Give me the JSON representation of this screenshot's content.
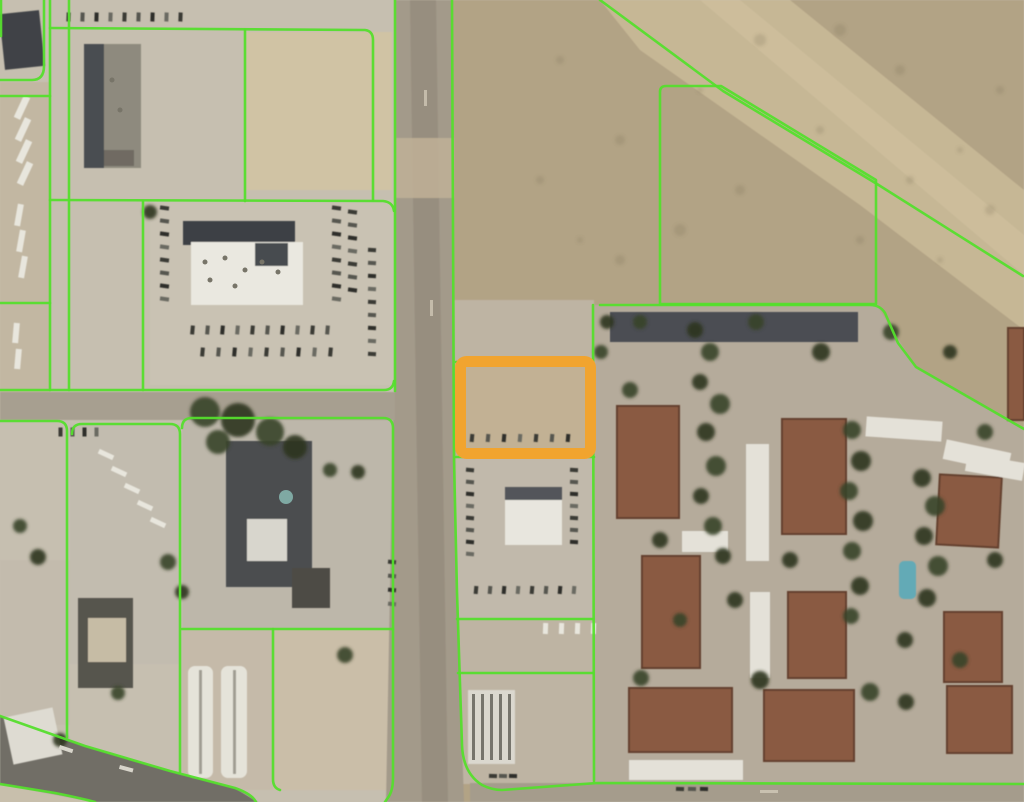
{
  "meta": {
    "view": "aerial-parcel-map",
    "description": "Satellite imagery with parcel boundary overlay and one selected parcel highlighted"
  },
  "palette": {
    "parcel_line": "#55DE2D",
    "highlight_orange": "#F1A42F",
    "urban_base": "#c6bfb0",
    "desert_base": "#b2a385",
    "road": "#a39a8a",
    "rust_roof": "#8a5a42",
    "rust_edge": "#64412f",
    "white_roof": "#e7e4da",
    "dark_roof": "#45484c",
    "tree_a": "#39422a",
    "tree_b": "#2c3520",
    "pool": "#64aab6",
    "car_dark": [
      "#3a3a36",
      "#565650",
      "#2f2f2b",
      "#6b6a62"
    ],
    "car_white": "#e8e6dd"
  },
  "map": {
    "width": 1024,
    "height": 802,
    "base": [
      {
        "t": "rect",
        "x": 0,
        "y": 0,
        "w": 1024,
        "h": 802,
        "f": "#c6bfb0"
      },
      {
        "t": "rect",
        "x": 452,
        "y": 0,
        "w": 572,
        "h": 802,
        "f": "#b2a385"
      },
      {
        "t": "poly",
        "pts": "600,0 790,0 1024,190 1024,330 860,205 640,50",
        "f": "#cbbb99",
        "o": 0.8
      },
      {
        "t": "poly",
        "pts": "700,0 740,0 1024,235 1024,275",
        "f": "#d3c4a1",
        "o": 0.5
      },
      {
        "t": "poly",
        "pts": "594,305 877,305 916,368 1024,430 1024,783 594,783",
        "f": "#b5ab9b"
      },
      {
        "t": "rect",
        "x": 452,
        "y": 300,
        "w": 142,
        "h": 484,
        "f": "#beb4a3"
      },
      {
        "t": "rect",
        "x": 455,
        "y": 360,
        "w": 140,
        "h": 98,
        "f": "#c2b194"
      },
      {
        "t": "rect",
        "x": 246,
        "y": 32,
        "w": 146,
        "h": 158,
        "f": "#d0c3a4"
      },
      {
        "t": "rect",
        "x": 0,
        "y": 82,
        "w": 50,
        "h": 310,
        "f": "#c2b7a2"
      },
      {
        "t": "rect",
        "x": 70,
        "y": 424,
        "w": 110,
        "h": 240,
        "f": "#c2bcaf"
      },
      {
        "t": "rect",
        "x": 182,
        "y": 418,
        "w": 211,
        "h": 211,
        "f": "#bdb7aa"
      },
      {
        "t": "rect",
        "x": 182,
        "y": 629,
        "w": 91,
        "h": 161,
        "f": "#c5baa9"
      },
      {
        "t": "rect",
        "x": 273,
        "y": 629,
        "w": 120,
        "h": 161,
        "f": "#cabea8"
      },
      {
        "t": "rect",
        "x": 0,
        "y": 560,
        "w": 70,
        "h": 165,
        "f": "#c3bbad"
      },
      {
        "t": "rect",
        "x": 150,
        "y": 200,
        "w": 245,
        "h": 185,
        "f": "#c9c2b3"
      },
      {
        "t": "rect",
        "x": 456,
        "y": 458,
        "w": 138,
        "h": 160,
        "f": "#c1b9ab"
      },
      {
        "t": "poly",
        "pts": "395,0 452,0 456,560 464,802 386,802 393,420 395,392",
        "f": "#a39a8a"
      },
      {
        "t": "rect",
        "x": 0,
        "y": 392,
        "w": 395,
        "h": 28,
        "f": "#a79f90"
      },
      {
        "t": "poly",
        "pts": "0,716 85,746 170,771 235,788 258,802 95,802 0,784",
        "f": "#716e66"
      },
      {
        "t": "poly",
        "pts": "0,784 95,802 0,802",
        "f": "#c8bfac"
      },
      {
        "t": "rect",
        "x": 470,
        "y": 783,
        "w": 554,
        "h": 19,
        "f": "#a59c8c"
      },
      {
        "t": "poly",
        "pts": "410,0 436,0 448,802 422,802",
        "f": "#938a7b",
        "o": 0.75
      },
      {
        "t": "rect",
        "x": 396,
        "y": 138,
        "w": 58,
        "h": 60,
        "f": "#c0b096",
        "o": 0.85
      }
    ],
    "buildings": [
      {
        "x": 2,
        "y": 12,
        "w": 40,
        "h": 56,
        "f": "#3f4246",
        "r": -6
      },
      {
        "x": 84,
        "y": 44,
        "w": 57,
        "h": 124,
        "f": "#8e8a7e"
      },
      {
        "x": 84,
        "y": 44,
        "w": 20,
        "h": 124,
        "f": "#4a4d51"
      },
      {
        "x": 104,
        "y": 150,
        "w": 30,
        "h": 16,
        "f": "#6f6b62"
      },
      {
        "x": 183,
        "y": 221,
        "w": 112,
        "h": 24,
        "f": "#3c4045"
      },
      {
        "x": 191,
        "y": 242,
        "w": 112,
        "h": 63,
        "f": "#eae8e0"
      },
      {
        "x": 255,
        "y": 243,
        "w": 33,
        "h": 23,
        "f": "#474b4f"
      },
      {
        "x": 226,
        "y": 441,
        "w": 86,
        "h": 146,
        "f": "#4c4e50"
      },
      {
        "x": 247,
        "y": 519,
        "w": 40,
        "h": 42,
        "f": "#d8d6cd"
      },
      {
        "x": 78,
        "y": 598,
        "w": 55,
        "h": 90,
        "f": "#57554d"
      },
      {
        "x": 88,
        "y": 618,
        "w": 38,
        "h": 44,
        "f": "#c6bca5"
      },
      {
        "x": 292,
        "y": 568,
        "w": 38,
        "h": 40,
        "f": "#4e4c45"
      },
      {
        "x": 188,
        "y": 666,
        "w": 25,
        "h": 112,
        "f": "#e5e3d9",
        "rx": 7
      },
      {
        "x": 199,
        "y": 670,
        "w": 3,
        "h": 104,
        "f": "#a09d92"
      },
      {
        "x": 221,
        "y": 666,
        "w": 26,
        "h": 112,
        "f": "#e5e3d9",
        "rx": 7
      },
      {
        "x": 233,
        "y": 670,
        "w": 3,
        "h": 104,
        "f": "#a09d92"
      },
      {
        "x": 8,
        "y": 712,
        "w": 50,
        "h": 48,
        "f": "#dedbd2",
        "r": -12
      },
      {
        "x": 505,
        "y": 487,
        "w": 57,
        "h": 58,
        "f": "#e8e6de"
      },
      {
        "x": 505,
        "y": 487,
        "w": 57,
        "h": 13,
        "f": "#53555a"
      },
      {
        "x": 468,
        "y": 690,
        "w": 47,
        "h": 74,
        "f": "#dbd8cf"
      },
      {
        "x": 610,
        "y": 312,
        "w": 248,
        "h": 30,
        "f": "#4b4e52"
      },
      {
        "x": 617,
        "y": 406,
        "w": 62,
        "h": 112,
        "f": "#8a5a42",
        "s": "#64412f"
      },
      {
        "x": 782,
        "y": 419,
        "w": 64,
        "h": 115,
        "f": "#8a5a42",
        "s": "#64412f"
      },
      {
        "x": 938,
        "y": 476,
        "w": 62,
        "h": 70,
        "f": "#8a5a42",
        "s": "#64412f",
        "r": 3
      },
      {
        "x": 642,
        "y": 556,
        "w": 58,
        "h": 112,
        "f": "#8a5a42",
        "s": "#64412f"
      },
      {
        "x": 788,
        "y": 592,
        "w": 58,
        "h": 86,
        "f": "#8a5a42",
        "s": "#64412f"
      },
      {
        "x": 944,
        "y": 612,
        "w": 58,
        "h": 70,
        "f": "#8a5a42",
        "s": "#64412f"
      },
      {
        "x": 629,
        "y": 688,
        "w": 103,
        "h": 64,
        "f": "#8a5a42",
        "s": "#64412f"
      },
      {
        "x": 764,
        "y": 690,
        "w": 90,
        "h": 71,
        "f": "#8a5a42",
        "s": "#64412f"
      },
      {
        "x": 947,
        "y": 686,
        "w": 65,
        "h": 67,
        "f": "#8a5a42",
        "s": "#64412f"
      },
      {
        "x": 1008,
        "y": 328,
        "w": 16,
        "h": 92,
        "f": "#8a5a42",
        "s": "#64412f"
      },
      {
        "x": 746,
        "y": 444,
        "w": 23,
        "h": 117,
        "f": "#e4e1d8"
      },
      {
        "x": 750,
        "y": 592,
        "w": 20,
        "h": 86,
        "f": "#e4e1d8"
      },
      {
        "x": 682,
        "y": 531,
        "w": 46,
        "h": 21,
        "f": "#e4e1d8"
      },
      {
        "x": 629,
        "y": 760,
        "w": 114,
        "h": 20,
        "f": "#e4e1d8"
      },
      {
        "x": 866,
        "y": 419,
        "w": 76,
        "h": 20,
        "f": "#e4e1d8",
        "r": 4
      },
      {
        "x": 944,
        "y": 446,
        "w": 66,
        "h": 20,
        "f": "#e4e1d8",
        "r": 12
      },
      {
        "x": 966,
        "y": 458,
        "w": 58,
        "h": 18,
        "f": "#e4e1d8",
        "r": 10
      },
      {
        "x": 899,
        "y": 561,
        "w": 17,
        "h": 38,
        "f": "#64aab6",
        "rx": 5
      }
    ],
    "trees": [
      [
        695,
        330,
        8
      ],
      [
        710,
        352,
        9
      ],
      [
        700,
        382,
        8
      ],
      [
        720,
        404,
        10
      ],
      [
        706,
        432,
        9
      ],
      [
        716,
        466,
        10
      ],
      [
        701,
        496,
        8
      ],
      [
        713,
        526,
        9
      ],
      [
        723,
        556,
        8
      ],
      [
        852,
        430,
        9
      ],
      [
        861,
        461,
        10
      ],
      [
        849,
        491,
        9
      ],
      [
        863,
        521,
        10
      ],
      [
        852,
        551,
        9
      ],
      [
        860,
        586,
        9
      ],
      [
        851,
        616,
        8
      ],
      [
        922,
        478,
        9
      ],
      [
        935,
        506,
        10
      ],
      [
        924,
        536,
        9
      ],
      [
        938,
        566,
        10
      ],
      [
        927,
        598,
        9
      ],
      [
        630,
        390,
        8
      ],
      [
        660,
        540,
        8
      ],
      [
        641,
        678,
        8
      ],
      [
        760,
        680,
        9
      ],
      [
        870,
        692,
        9
      ],
      [
        906,
        702,
        8
      ],
      [
        960,
        660,
        8
      ],
      [
        995,
        560,
        8
      ],
      [
        640,
        322,
        7
      ],
      [
        790,
        560,
        8
      ],
      [
        756,
        322,
        8
      ],
      [
        821,
        352,
        9
      ],
      [
        891,
        332,
        8
      ],
      [
        950,
        352,
        7
      ],
      [
        985,
        432,
        8
      ],
      [
        607,
        322,
        7
      ],
      [
        601,
        352,
        7
      ],
      [
        735,
        600,
        8
      ],
      [
        680,
        620,
        7
      ],
      [
        905,
        640,
        8
      ],
      [
        205,
        412,
        15
      ],
      [
        238,
        420,
        17
      ],
      [
        270,
        432,
        14
      ],
      [
        295,
        447,
        12
      ],
      [
        218,
        442,
        12
      ],
      [
        150,
        212,
        7
      ],
      [
        168,
        562,
        8
      ],
      [
        182,
        592,
        7
      ],
      [
        20,
        526,
        7
      ],
      [
        38,
        557,
        8
      ],
      [
        345,
        655,
        8
      ],
      [
        358,
        472,
        7
      ],
      [
        118,
        693,
        7
      ],
      [
        60,
        740,
        7
      ],
      [
        330,
        470,
        7
      ]
    ],
    "speckles": [
      [
        560,
        60,
        4
      ],
      [
        620,
        140,
        5
      ],
      [
        700,
        90,
        3
      ],
      [
        760,
        40,
        6
      ],
      [
        820,
        130,
        4
      ],
      [
        900,
        70,
        5
      ],
      [
        960,
        150,
        3
      ],
      [
        1000,
        90,
        4
      ],
      [
        680,
        230,
        6
      ],
      [
        740,
        190,
        5
      ],
      [
        860,
        240,
        4
      ],
      [
        940,
        260,
        3
      ],
      [
        620,
        260,
        5
      ],
      [
        540,
        180,
        4
      ],
      [
        580,
        240,
        3
      ],
      [
        990,
        210,
        5
      ],
      [
        910,
        180,
        4
      ],
      [
        840,
        30,
        6
      ]
    ],
    "dots": [
      {
        "cx": 205,
        "cy": 262,
        "r": 2.5,
        "f": "#777468"
      },
      {
        "cx": 225,
        "cy": 258,
        "r": 2.5,
        "f": "#777468"
      },
      {
        "cx": 245,
        "cy": 270,
        "r": 2.5,
        "f": "#777468"
      },
      {
        "cx": 262,
        "cy": 262,
        "r": 2.5,
        "f": "#777468"
      },
      {
        "cx": 278,
        "cy": 272,
        "r": 2.5,
        "f": "#777468"
      },
      {
        "cx": 235,
        "cy": 286,
        "r": 2.5,
        "f": "#777468"
      },
      {
        "cx": 210,
        "cy": 280,
        "r": 2.5,
        "f": "#777468"
      },
      {
        "cx": 112,
        "cy": 80,
        "r": 2.5,
        "f": "#777468"
      },
      {
        "cx": 120,
        "cy": 110,
        "r": 2.5,
        "f": "#777468"
      },
      {
        "cx": 286,
        "cy": 497,
        "r": 7,
        "f": "#7fa9a3"
      }
    ],
    "marks": [
      {
        "x": 472,
        "y": 694,
        "w": 3,
        "h": 66,
        "f": "#77756d"
      },
      {
        "x": 481,
        "y": 694,
        "w": 3,
        "h": 66,
        "f": "#77756d"
      },
      {
        "x": 490,
        "y": 694,
        "w": 3,
        "h": 66,
        "f": "#77756d"
      },
      {
        "x": 499,
        "y": 694,
        "w": 3,
        "h": 66,
        "f": "#77756d"
      },
      {
        "x": 508,
        "y": 694,
        "w": 3,
        "h": 66,
        "f": "#77756d"
      },
      {
        "x": 60,
        "y": 745,
        "w": 14,
        "h": 4,
        "f": "#d8d5cb",
        "r": 18
      },
      {
        "x": 120,
        "y": 765,
        "w": 14,
        "h": 4,
        "f": "#d8d5cb",
        "r": 15
      },
      {
        "x": 760,
        "y": 790,
        "w": 18,
        "h": 3,
        "f": "#c9c1b0"
      },
      {
        "x": 424,
        "y": 90,
        "w": 3,
        "h": 16,
        "f": "#c4bbaa"
      },
      {
        "x": 430,
        "y": 300,
        "w": 3,
        "h": 16,
        "f": "#c4bbaa"
      }
    ],
    "car_rows": [
      {
        "x": 160,
        "y": 206,
        "n": 8,
        "dx": 0,
        "dy": 13,
        "l": 9,
        "w": 4,
        "rot": 8,
        "c": "dark"
      },
      {
        "x": 332,
        "y": 206,
        "n": 8,
        "dx": 0,
        "dy": 13,
        "l": 9,
        "w": 4,
        "rot": 8,
        "c": "dark"
      },
      {
        "x": 348,
        "y": 210,
        "n": 7,
        "dx": 0,
        "dy": 13,
        "l": 9,
        "w": 4,
        "rot": 8,
        "c": "dark"
      },
      {
        "x": 368,
        "y": 248,
        "n": 9,
        "dx": 0,
        "dy": 13,
        "l": 8,
        "w": 4,
        "rot": 4,
        "c": "dark"
      },
      {
        "x": 188,
        "y": 328,
        "n": 10,
        "dx": 15,
        "dy": 0,
        "l": 9,
        "w": 4,
        "rot": 95,
        "c": "dark"
      },
      {
        "x": 198,
        "y": 350,
        "n": 9,
        "dx": 16,
        "dy": 0,
        "l": 9,
        "w": 4,
        "rot": 95,
        "c": "dark"
      },
      {
        "x": 10,
        "y": 104,
        "n": 4,
        "dx": 1,
        "dy": 22,
        "l": 24,
        "w": 7,
        "rot": 115,
        "c": "white"
      },
      {
        "x": 8,
        "y": 212,
        "n": 3,
        "dx": 2,
        "dy": 26,
        "l": 22,
        "w": 6,
        "rot": 100,
        "c": "white"
      },
      {
        "x": 6,
        "y": 330,
        "n": 2,
        "dx": 2,
        "dy": 26,
        "l": 20,
        "w": 6,
        "rot": 95,
        "c": "white"
      },
      {
        "x": 64,
        "y": 15,
        "n": 9,
        "dx": 14,
        "dy": 0,
        "l": 9,
        "w": 4,
        "rot": 92,
        "c": "dark"
      },
      {
        "x": 98,
        "y": 452,
        "n": 5,
        "dx": 13,
        "dy": 17,
        "l": 16,
        "w": 5,
        "rot": 25,
        "c": "white"
      },
      {
        "x": 466,
        "y": 468,
        "n": 8,
        "dx": 0,
        "dy": 12,
        "l": 8,
        "w": 4,
        "rot": 5,
        "c": "dark"
      },
      {
        "x": 570,
        "y": 468,
        "n": 7,
        "dx": 0,
        "dy": 12,
        "l": 8,
        "w": 4,
        "rot": 3,
        "c": "dark"
      },
      {
        "x": 472,
        "y": 588,
        "n": 8,
        "dx": 14,
        "dy": 0,
        "l": 8,
        "w": 4,
        "rot": 95,
        "c": "dark"
      },
      {
        "x": 468,
        "y": 436,
        "n": 7,
        "dx": 16,
        "dy": 0,
        "l": 8,
        "w": 4,
        "rot": 95,
        "c": "dark"
      },
      {
        "x": 540,
        "y": 626,
        "n": 4,
        "dx": 16,
        "dy": 0,
        "l": 11,
        "w": 5,
        "rot": 92,
        "c": "white"
      },
      {
        "x": 676,
        "y": 787,
        "n": 3,
        "dx": 12,
        "dy": 0,
        "l": 8,
        "w": 4,
        "rot": 2,
        "c": "dark"
      },
      {
        "x": 489,
        "y": 774,
        "n": 3,
        "dx": 10,
        "dy": 0,
        "l": 8,
        "w": 4,
        "rot": 2,
        "c": "dark"
      },
      {
        "x": 388,
        "y": 560,
        "n": 4,
        "dx": 0,
        "dy": 14,
        "l": 8,
        "w": 4,
        "rot": 6,
        "c": "dark"
      },
      {
        "x": 56,
        "y": 430,
        "n": 4,
        "dx": 12,
        "dy": 0,
        "l": 9,
        "w": 4,
        "rot": 90,
        "c": "dark"
      }
    ],
    "parcel_lines": {
      "color": "#55DE2D",
      "width": 2.6,
      "paths": [
        "M1 0 L1 36",
        "M44 0 L44 66 Q44 80 32 80 L0 80",
        "M50 0 L50 390",
        "M69 0 L69 390",
        "M50 28 L365 30 Q373 31 373 40 L373 200",
        "M395 0 L395 391",
        "M0 390 L384 390 Q393 390 394 381",
        "M50 200 L383 201 Q393 202 394 211",
        "M245 30 L245 201",
        "M143 201 L143 390",
        "M0 96 L50 96",
        "M0 303 L50 303",
        "M0 421 L57 421 Q67 421 67 431 L67 737",
        "M72 434 Q72 424 82 424 L170 424 Q180 424 180 434 L180 772",
        "M182 428 Q182 418 192 418 L383 418 Q393 418 393 428 L393 778 Q393 792 387 799 L385 802",
        "M182 629 L393 629",
        "M273 629 L273 779 Q273 788 280 790",
        "M0 716 L85 746 L170 771 L235 788 Q252 794 256 802",
        "M0 784 L55 793 Q80 798 95 802",
        "M452 0 L454 460 L457 592 L462 745 Q463 773 482 785 Q492 790 502 790 L597 783 L1024 784",
        "M456 457 L594 457",
        "M456 362 L592 362",
        "M457 619 L593 619",
        "M458 673 L593 673",
        "M593 305 L594 781",
        "M600 305 L870 305 Q880 305 885 313 L898 343 L916 367 L1024 429",
        "M660 304 L660 92 Q660 86 666 86 L721 86 L876 180 L876 304 L661 304",
        "M600 0 L723 91 L877 184 L1023 276"
      ]
    },
    "highlight": {
      "x": 460.5,
      "y": 361.5,
      "w": 130,
      "h": 92,
      "stroke": "#F1A42F",
      "stroke_width": 11,
      "radius": 6
    }
  }
}
